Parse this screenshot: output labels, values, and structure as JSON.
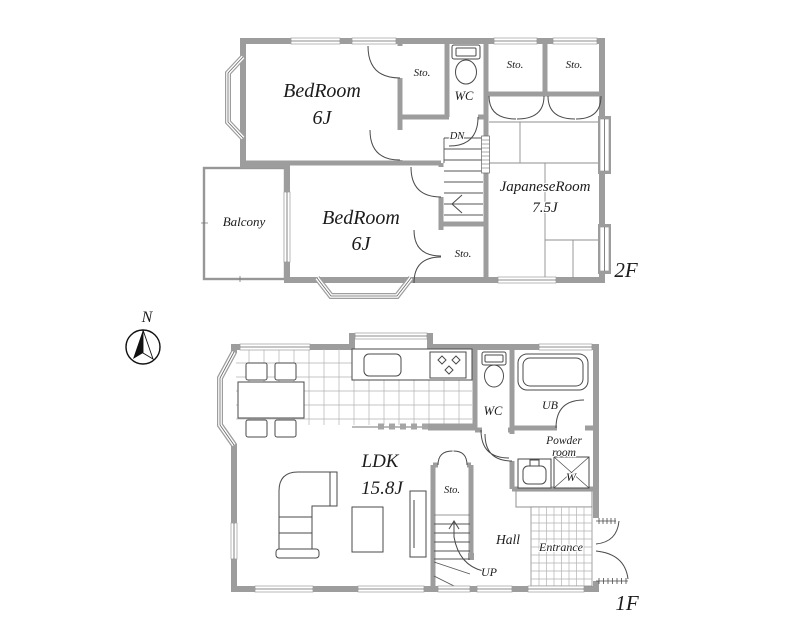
{
  "colors": {
    "wall": "#9d9d9d",
    "line": "#4a4a4a",
    "text": "#1c1c1c",
    "background": "#ffffff"
  },
  "floor2": {
    "floor_label": "2F",
    "bedroom_top": {
      "name": "BedRoom",
      "size": "6J"
    },
    "bedroom_bottom": {
      "name": "BedRoom",
      "size": "6J"
    },
    "japanese_room": {
      "name": "JapaneseRoom",
      "size": "7.5J"
    },
    "balcony_label": "Balcony",
    "wc_label": "WC",
    "storage_top_label": "Sto.",
    "storage_right1_label": "Sto.",
    "storage_right2_label": "Sto.",
    "storage_bottom_label": "Sto.",
    "stairs_label": "DN"
  },
  "floor1": {
    "floor_label": "1F",
    "ldk": {
      "name": "LDK",
      "size": "15.8J"
    },
    "wc_label": "WC",
    "bath_label": "UB",
    "powder_line1": "Powder",
    "powder_line2": "room",
    "washer_label": "W",
    "storage_label": "Sto.",
    "hall_label": "Hall",
    "entrance_label": "Entrance",
    "stairs_label": "UP"
  },
  "compass": {
    "north_label": "N"
  }
}
